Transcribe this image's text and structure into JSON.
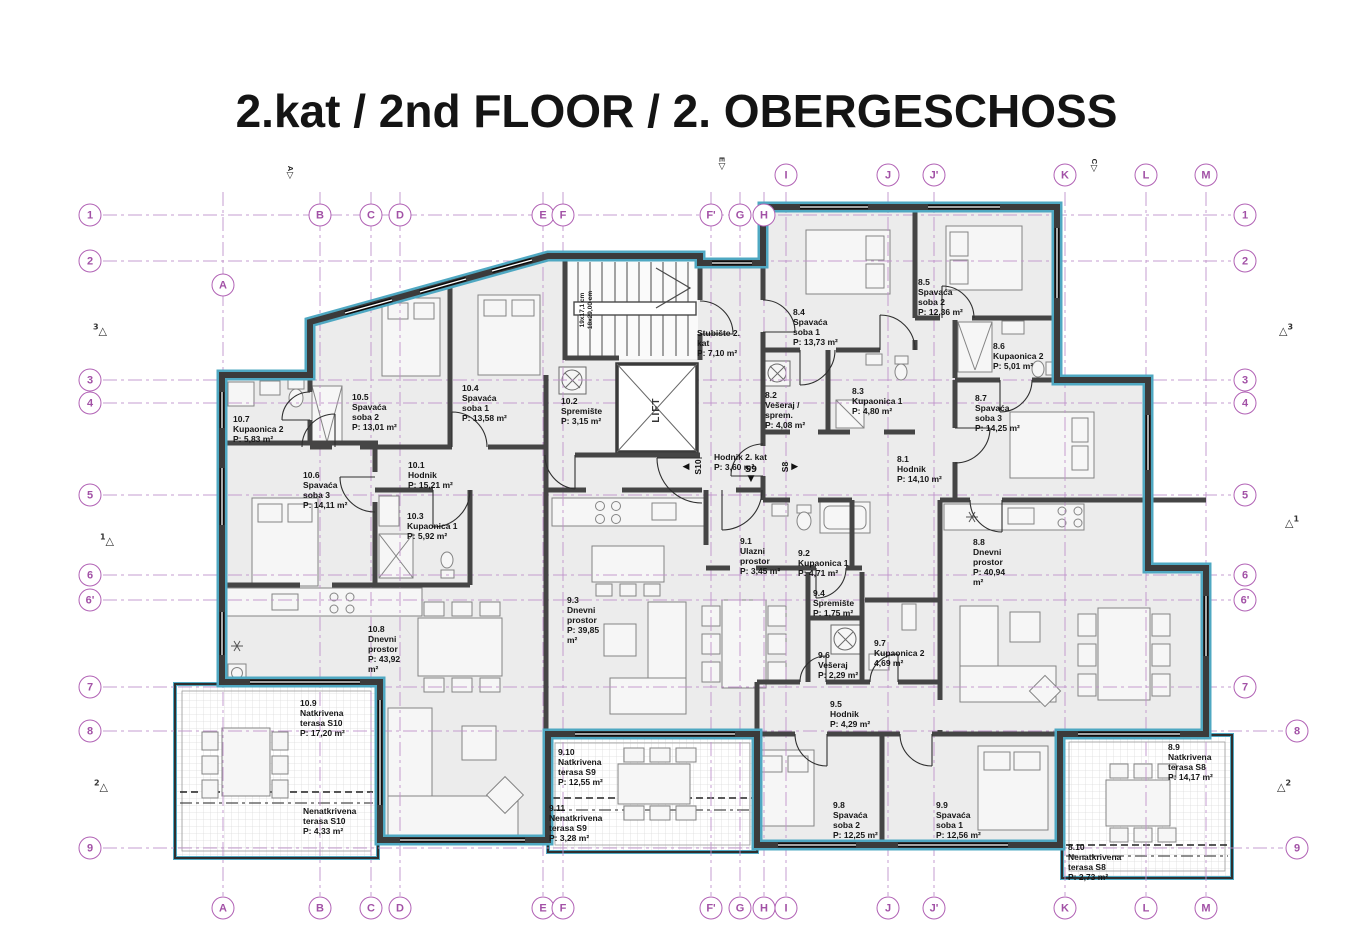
{
  "title": "2.kat / 2nd FLOOR / 2. OBERGESCHOSS",
  "colors": {
    "grid_purple": "#b162b5",
    "grid_line": "#c093cb",
    "wall_dark": "#3b3b3b",
    "insulation_teal": "#4fa8c2",
    "room_fill": "#ececec"
  },
  "grid": {
    "columns": [
      {
        "label": "A",
        "x": 223,
        "top_y": 285
      },
      {
        "label": "B",
        "x": 320,
        "top_y": 215
      },
      {
        "label": "C",
        "x": 371,
        "top_y": 215
      },
      {
        "label": "D",
        "x": 400,
        "top_y": 215
      },
      {
        "label": "E",
        "x": 543,
        "top_y": 215
      },
      {
        "label": "F",
        "x": 563,
        "top_y": 215
      },
      {
        "label": "F'",
        "x": 711,
        "top_y": 215
      },
      {
        "label": "G",
        "x": 740,
        "top_y": 215
      },
      {
        "label": "H",
        "x": 764,
        "top_y": 215
      },
      {
        "label": "I",
        "x": 786,
        "top_y": 175
      },
      {
        "label": "J",
        "x": 888,
        "top_y": 175
      },
      {
        "label": "J'",
        "x": 934,
        "top_y": 175
      },
      {
        "label": "K",
        "x": 1065,
        "top_y": 175
      },
      {
        "label": "L",
        "x": 1146,
        "top_y": 175
      },
      {
        "label": "M",
        "x": 1206,
        "top_y": 175
      }
    ],
    "bottom_y": 908,
    "left_x": 90,
    "rows": [
      {
        "label": "1",
        "y": 215,
        "rx": 1245
      },
      {
        "label": "2",
        "y": 261,
        "rx": 1245
      },
      {
        "label": "3",
        "y": 380,
        "rx": 1245
      },
      {
        "label": "4",
        "y": 403,
        "rx": 1245
      },
      {
        "label": "5",
        "y": 495,
        "rx": 1245
      },
      {
        "label": "6",
        "y": 575,
        "rx": 1245
      },
      {
        "label": "6'",
        "y": 600,
        "rx": 1245
      },
      {
        "label": "7",
        "y": 687,
        "rx": 1245
      },
      {
        "label": "8",
        "y": 731,
        "rx": 1297
      },
      {
        "label": "9",
        "y": 848,
        "rx": 1297
      }
    ]
  },
  "rooms": [
    {
      "id": "10.7",
      "name": "Kupaonica 2",
      "area": "P: 5,83 m²",
      "x": 233,
      "y": 414,
      "w": 62
    },
    {
      "id": "10.5",
      "name": "Spavaća soba 2",
      "area": "P: 13,01 m²",
      "x": 352,
      "y": 392,
      "w": 48
    },
    {
      "id": "10.4",
      "name": "Spavaća soba 1",
      "area": "P: 13,58 m²",
      "x": 462,
      "y": 383,
      "w": 48
    },
    {
      "id": "10.2",
      "name": "Spremište",
      "area": "P: 3,15 m²",
      "x": 561,
      "y": 396,
      "w": 52
    },
    {
      "id": "",
      "name": "Stubište 2. kat",
      "area": "P: 7,10 m²",
      "x": 697,
      "y": 328,
      "w": 52
    },
    {
      "id": "8.4",
      "name": "Spavaća soba 1",
      "area": "P: 13,73 m²",
      "x": 793,
      "y": 307,
      "w": 48
    },
    {
      "id": "8.5",
      "name": "Spavaća soba 2",
      "area": "P: 12,36 m²",
      "x": 918,
      "y": 277,
      "w": 48
    },
    {
      "id": "8.6",
      "name": "Kupaonica 2",
      "area": "P: 5,01 m²",
      "x": 993,
      "y": 341,
      "w": 62
    },
    {
      "id": "8.2",
      "name": "Vešeraj / sprem.",
      "area": "P: 4,08 m²",
      "x": 765,
      "y": 390,
      "w": 46
    },
    {
      "id": "8.3",
      "name": "Kupaonica 1",
      "area": "P: 4,80 m²",
      "x": 852,
      "y": 386,
      "w": 62
    },
    {
      "id": "8.7",
      "name": "Spavaća soba 3",
      "area": "P: 14,25 m²",
      "x": 975,
      "y": 393,
      "w": 48
    },
    {
      "id": "10.6",
      "name": "Spavaća soba 3",
      "area": "P: 14,11 m²",
      "x": 303,
      "y": 470,
      "w": 48
    },
    {
      "id": "10.1",
      "name": "Hodnik",
      "area": "P: 15,21 m²",
      "x": 408,
      "y": 460,
      "w": 62
    },
    {
      "id": "10.3",
      "name": "Kupaonica 1",
      "area": "P: 5,92 m²",
      "x": 407,
      "y": 511,
      "w": 62
    },
    {
      "id": "",
      "name": "Hodnik 2. kat",
      "area": "P: 3,60 m²",
      "x": 714,
      "y": 452,
      "w": 72
    },
    {
      "id": "8.1",
      "name": "Hodnik",
      "area": "P: 14,10 m²",
      "x": 897,
      "y": 454,
      "w": 62
    },
    {
      "id": "9.1",
      "name": "Ulazni prostor",
      "area": "P: 3,45 m²",
      "x": 740,
      "y": 536,
      "w": 44
    },
    {
      "id": "9.2",
      "name": "Kupaonica 1",
      "area": "P: 4,71 m²",
      "x": 798,
      "y": 548,
      "w": 62
    },
    {
      "id": "8.8",
      "name": "Dnevni prostor",
      "area": "P: 40,94 m²",
      "x": 973,
      "y": 537,
      "w": 44
    },
    {
      "id": "9.4",
      "name": "Spremište",
      "area": "P: 1,75 m²",
      "x": 813,
      "y": 588,
      "w": 52
    },
    {
      "id": "9.6",
      "name": "Vešeraj",
      "area": "P: 2,29 m²",
      "x": 818,
      "y": 650,
      "w": 46
    },
    {
      "id": "9.7",
      "name": "Kupaonica 2",
      "area": "4,69 m²",
      "x": 874,
      "y": 638,
      "w": 62
    },
    {
      "id": "9.5",
      "name": "Hodnik",
      "area": "P: 4,29 m²",
      "x": 830,
      "y": 699,
      "w": 62
    },
    {
      "id": "10.8",
      "name": "Dnevni prostor",
      "area": "P: 43,92 m²",
      "x": 368,
      "y": 624,
      "w": 44
    },
    {
      "id": "9.3",
      "name": "Dnevni prostor",
      "area": "P: 39,85 m²",
      "x": 567,
      "y": 595,
      "w": 44
    },
    {
      "id": "10.9",
      "name": "Natkrivena terasa S10",
      "area": "P: 17,20 m²",
      "x": 300,
      "y": 698,
      "w": 58
    },
    {
      "id": "",
      "name": "Nenatkrivena terasa S10",
      "area": "P: 4,33 m²",
      "x": 303,
      "y": 806,
      "w": 66
    },
    {
      "id": "9.10",
      "name": "Natkrivena terasa S9",
      "area": "P: 12,55 m²",
      "x": 558,
      "y": 747,
      "w": 56
    },
    {
      "id": "9.11",
      "name": "Nenatkrivena terasa S9",
      "area": "P: 3,28 m²",
      "x": 549,
      "y": 803,
      "w": 66
    },
    {
      "id": "9.8",
      "name": "Spavaća soba 2",
      "area": "P: 12,25 m²",
      "x": 833,
      "y": 800,
      "w": 48
    },
    {
      "id": "9.9",
      "name": "Spavaća soba 1",
      "area": "P: 12,56 m²",
      "x": 936,
      "y": 800,
      "w": 48
    },
    {
      "id": "8.9",
      "name": "Natkrivena terasa S8",
      "area": "P: 14,17 m²",
      "x": 1168,
      "y": 742,
      "w": 56
    },
    {
      "id": "8.10",
      "name": "Nenatkrivena terasa S8",
      "area": "P: 2,73 m²",
      "x": 1068,
      "y": 842,
      "w": 66
    }
  ],
  "stair": {
    "lift_label": "LIFT",
    "dim_line1": "19x17,1 cm",
    "dim_line2": "18x29,00 cm"
  },
  "markers": {
    "top_flags": [
      {
        "label": "A",
        "x": 290,
        "y": 165
      },
      {
        "label": "E",
        "x": 722,
        "y": 156
      },
      {
        "label": "C",
        "x": 1094,
        "y": 158
      }
    ],
    "left_triangles": [
      {
        "label": "3",
        "x": 100,
        "y": 330
      },
      {
        "label": "1",
        "x": 107,
        "y": 540
      },
      {
        "label": "2",
        "x": 101,
        "y": 786
      }
    ],
    "right_triangles": [
      {
        "label": "3",
        "x": 1286,
        "y": 330
      },
      {
        "label": "1",
        "x": 1292,
        "y": 522
      },
      {
        "label": "2",
        "x": 1284,
        "y": 786
      }
    ],
    "section_arrows": [
      {
        "label": "S10",
        "x": 694,
        "y": 467,
        "dir": "left"
      },
      {
        "label": "S9",
        "x": 751,
        "y": 474,
        "dir": "down"
      },
      {
        "label": "S8",
        "x": 789,
        "y": 467,
        "dir": "right"
      }
    ]
  }
}
